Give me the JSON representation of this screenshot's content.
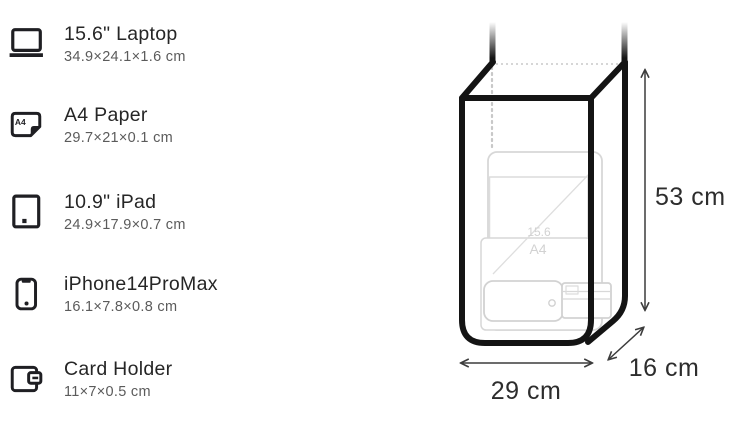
{
  "page": {
    "background": "#ffffff"
  },
  "items": [
    {
      "icon": "laptop-icon",
      "label": "15.6\" Laptop",
      "dims": "34.9×24.1×1.6 cm"
    },
    {
      "icon": "a4-paper-icon",
      "label": "A4 Paper",
      "dims": "29.7×21×0.1 cm"
    },
    {
      "icon": "ipad-icon",
      "label": "10.9\" iPad",
      "dims": "24.9×17.9×0.7 cm"
    },
    {
      "icon": "iphone-icon",
      "label": "iPhone14ProMax",
      "dims": "16.1×7.8×0.8 cm"
    },
    {
      "icon": "card-holder-icon",
      "label": "Card Holder",
      "dims": "11×7×0.5 cm"
    }
  ],
  "icon_text": {
    "a4_badge": "A4"
  },
  "diagram": {
    "width_label": "29 cm",
    "depth_label": "16 cm",
    "height_label": "53 cm",
    "ghost_labels": {
      "laptop": "15.6",
      "a4": "A4"
    },
    "colors": {
      "bag_outline": "#141414",
      "dotted_hidden_edge": "#c8c8c8",
      "ghost_items": "#d5d5d5",
      "dimension_arrows": "#3c3c3c",
      "dimension_text": "#2d2d2d",
      "item_label": "#262626",
      "item_dims": "#5b5b5b"
    }
  }
}
